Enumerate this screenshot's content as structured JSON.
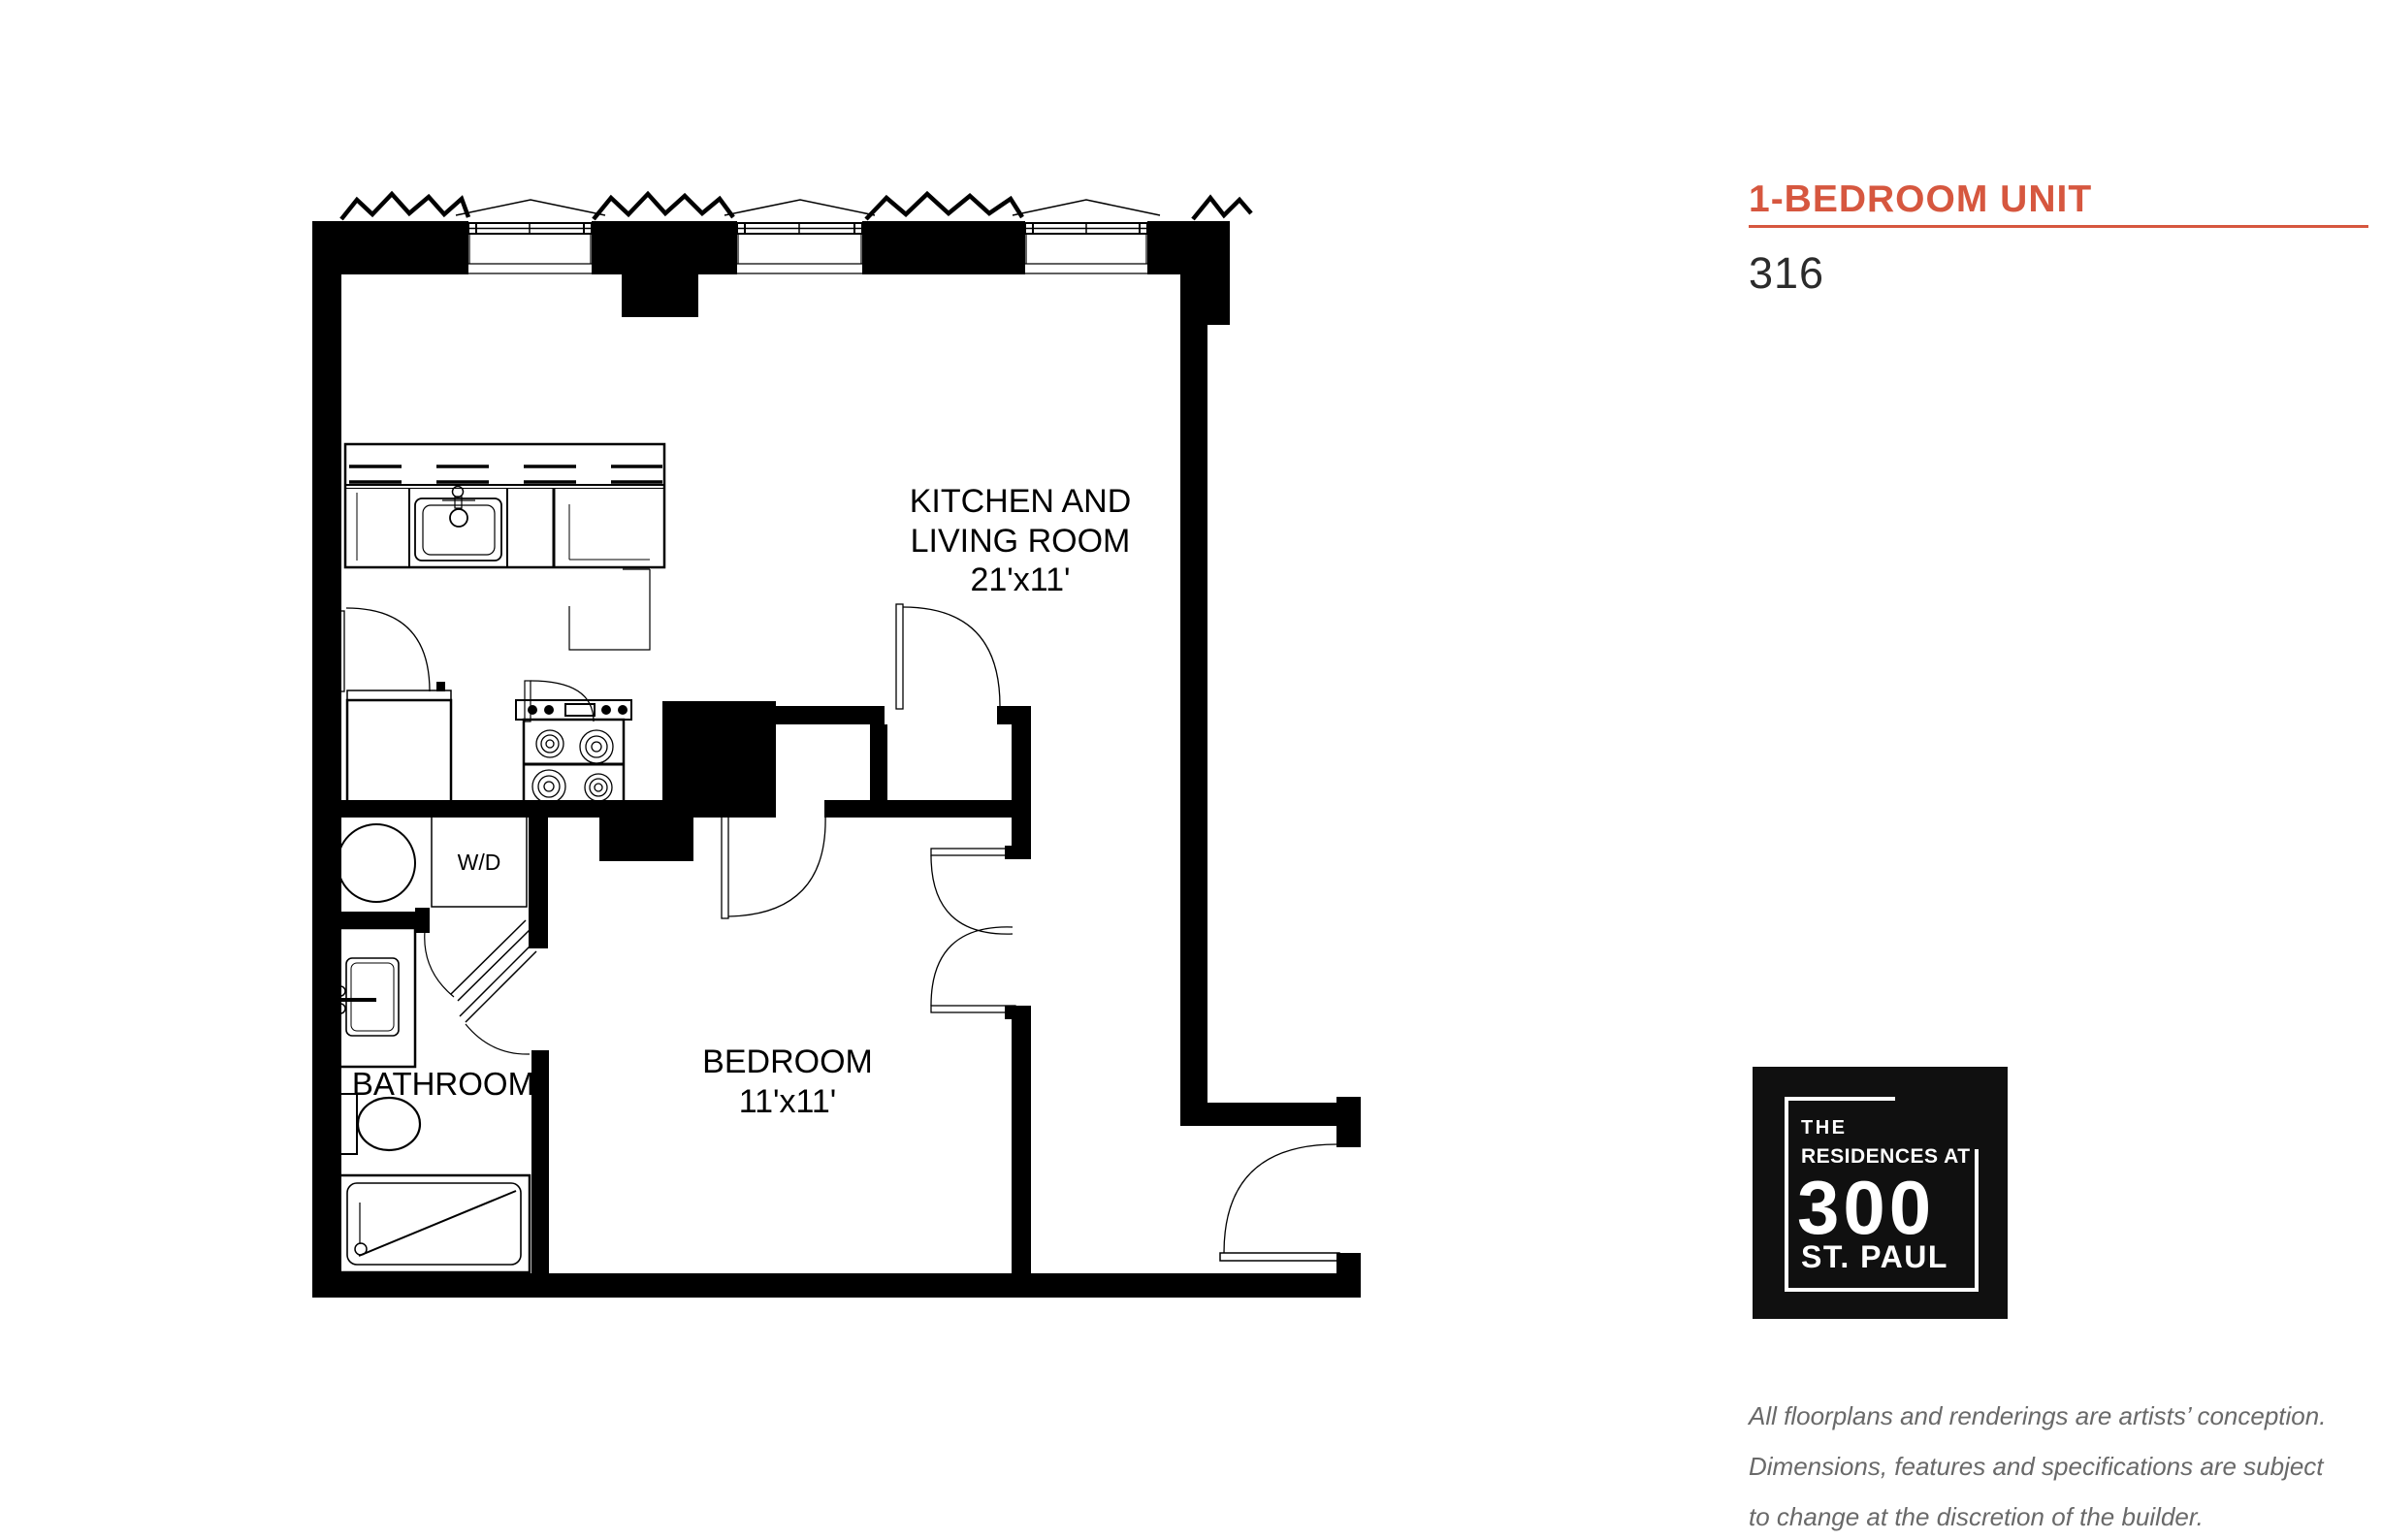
{
  "header": {
    "title": "1-BEDROOM UNIT",
    "unit_number": "316"
  },
  "colors": {
    "accent": "#D6573F",
    "logo_bg": "#101010",
    "text_dark": "#2B2B2B",
    "disclaimer_gray": "#696969"
  },
  "floorplan": {
    "labels": {
      "kitchen_living_line1": "KITCHEN AND",
      "kitchen_living_line2": "LIVING ROOM",
      "kitchen_living_dims": "21'x11'",
      "bedroom_name": "BEDROOM",
      "bedroom_dims": "11'x11'",
      "bathroom_name": "BATHROOM",
      "laundry_label": "W/D"
    }
  },
  "logo": {
    "line1": "THE",
    "line2": "RESIDENCES AT",
    "number": "300",
    "line3": "ST. PAUL"
  },
  "disclaimer": {
    "line1": "All floorplans and renderings are artists’ conception.",
    "line2": "Dimensions, features and specifications are subject",
    "line3": "to change at the discretion of the builder."
  }
}
